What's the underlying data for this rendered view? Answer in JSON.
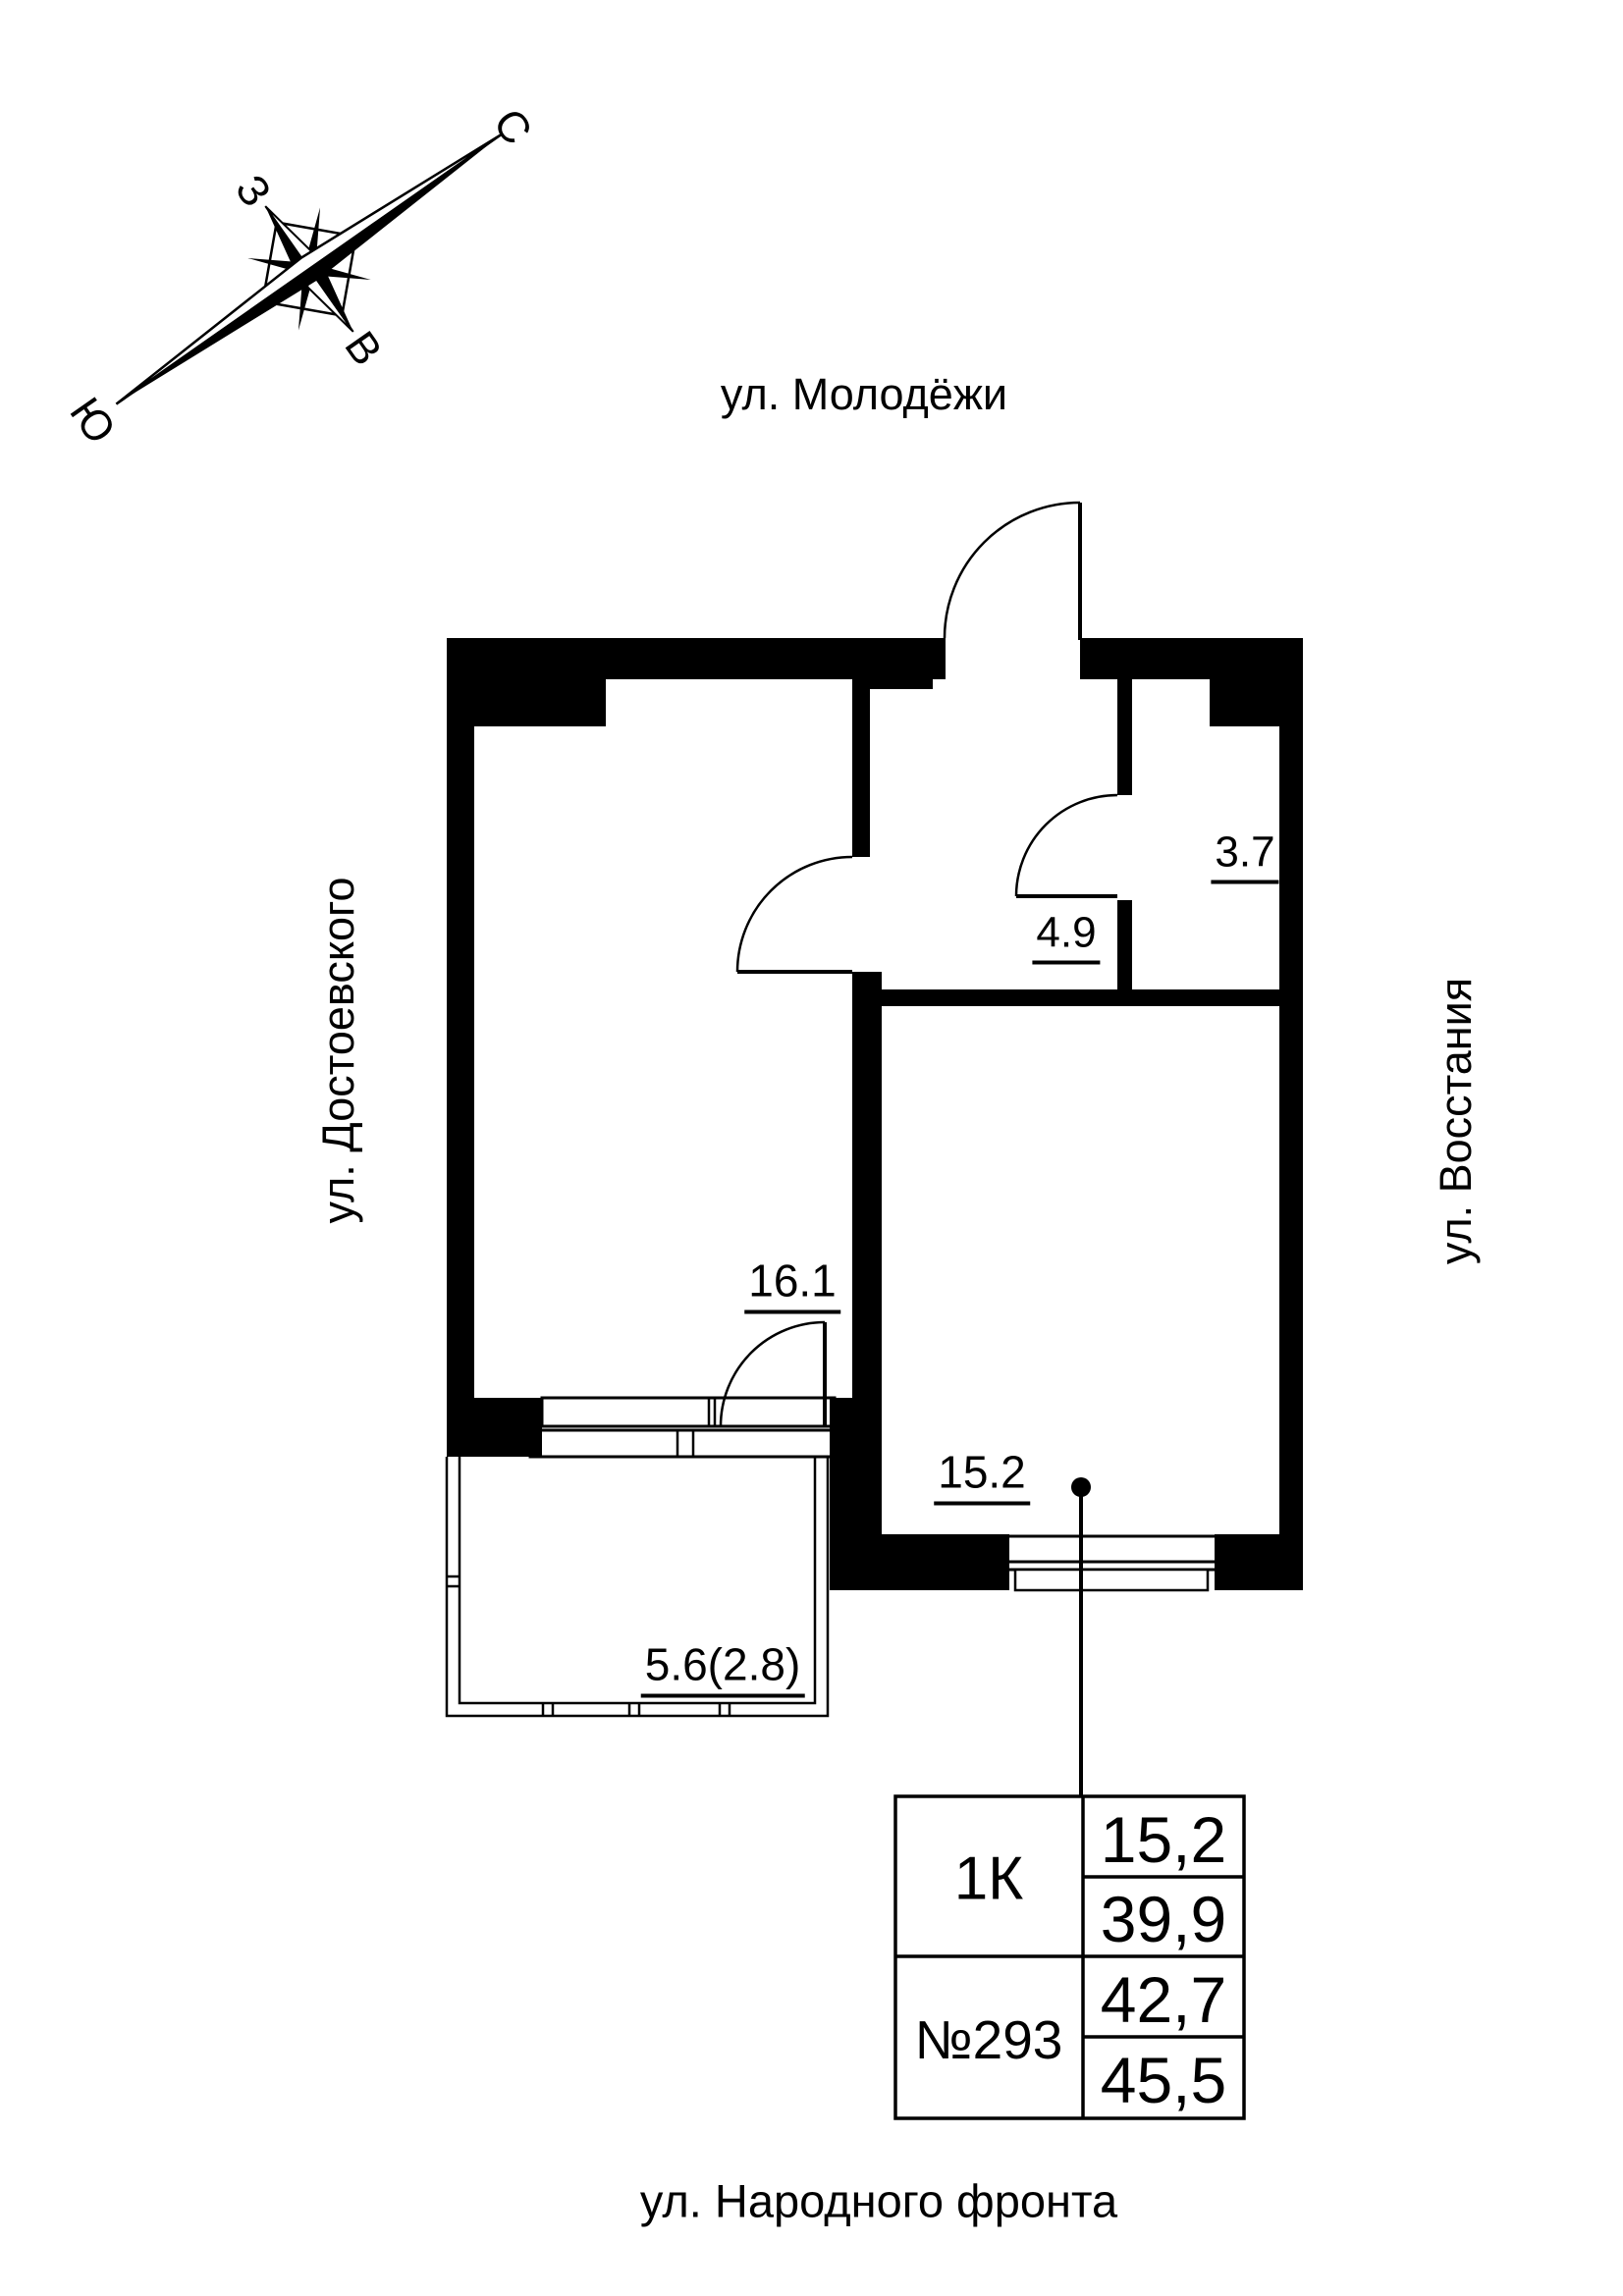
{
  "colors": {
    "ink": "#000000",
    "paper": "#ffffff"
  },
  "compass": {
    "north": "С",
    "south": "Ю",
    "west": "З",
    "east": "В"
  },
  "streets": {
    "top": "ул. Молодёжи",
    "left": "ул. Достоевского",
    "right": "ул. Восстания",
    "bottom": "ул. Народного фронта"
  },
  "rooms": {
    "room_main": "16.1",
    "room_second": "15.2",
    "hallway": "4.9",
    "bathroom": "3.7",
    "balcony": "5.6(2.8)"
  },
  "info_table": {
    "unit_type": "1К",
    "unit_number": "№293",
    "type_rows": [
      "15,2",
      "39,9"
    ],
    "number_rows": [
      "42,7",
      "45,5"
    ]
  }
}
